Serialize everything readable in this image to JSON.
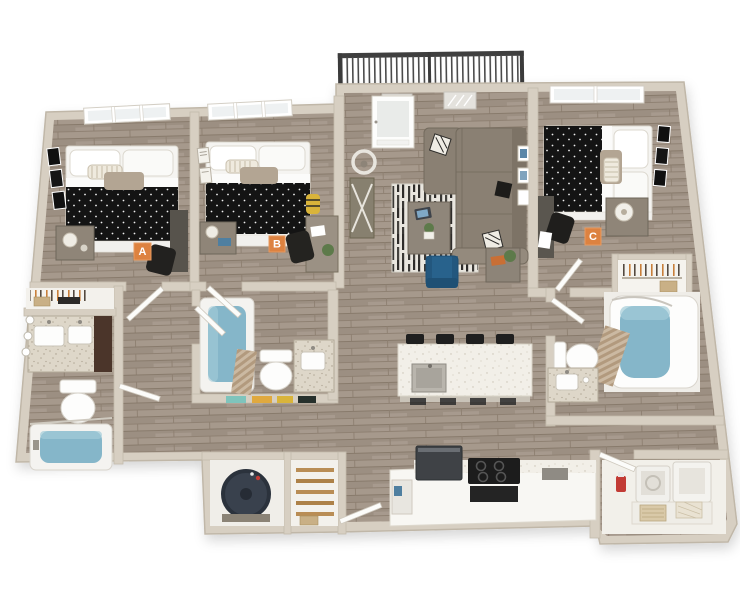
{
  "floorplan": {
    "units": [
      {
        "id": "bedroom-a",
        "label": "A"
      },
      {
        "id": "bedroom-b",
        "label": "B"
      },
      {
        "id": "bedroom-c",
        "label": "C"
      }
    ],
    "colors": {
      "background": "#ffffff",
      "unit_label_bg": "#dd8240",
      "unit_label_border": "#e89a60",
      "unit_label_text": "#ffffff",
      "wall": "#d7cfc2",
      "wall_edge": "#c0b7a8",
      "floor_wood": "#a4978a",
      "tub_water": "#85b6c9",
      "sofa_gray": "#8a8073",
      "accent_chair_blue": "#28628c",
      "railing_dark": "#454545",
      "duvet_black": "#141414",
      "vanity_wood": "#4b352a",
      "pantry_shelf": "#b98d55",
      "towel_teal": "#7fc4bc",
      "towel_yellow": "#e0a93f",
      "detergent_red": "#c23b35"
    }
  }
}
